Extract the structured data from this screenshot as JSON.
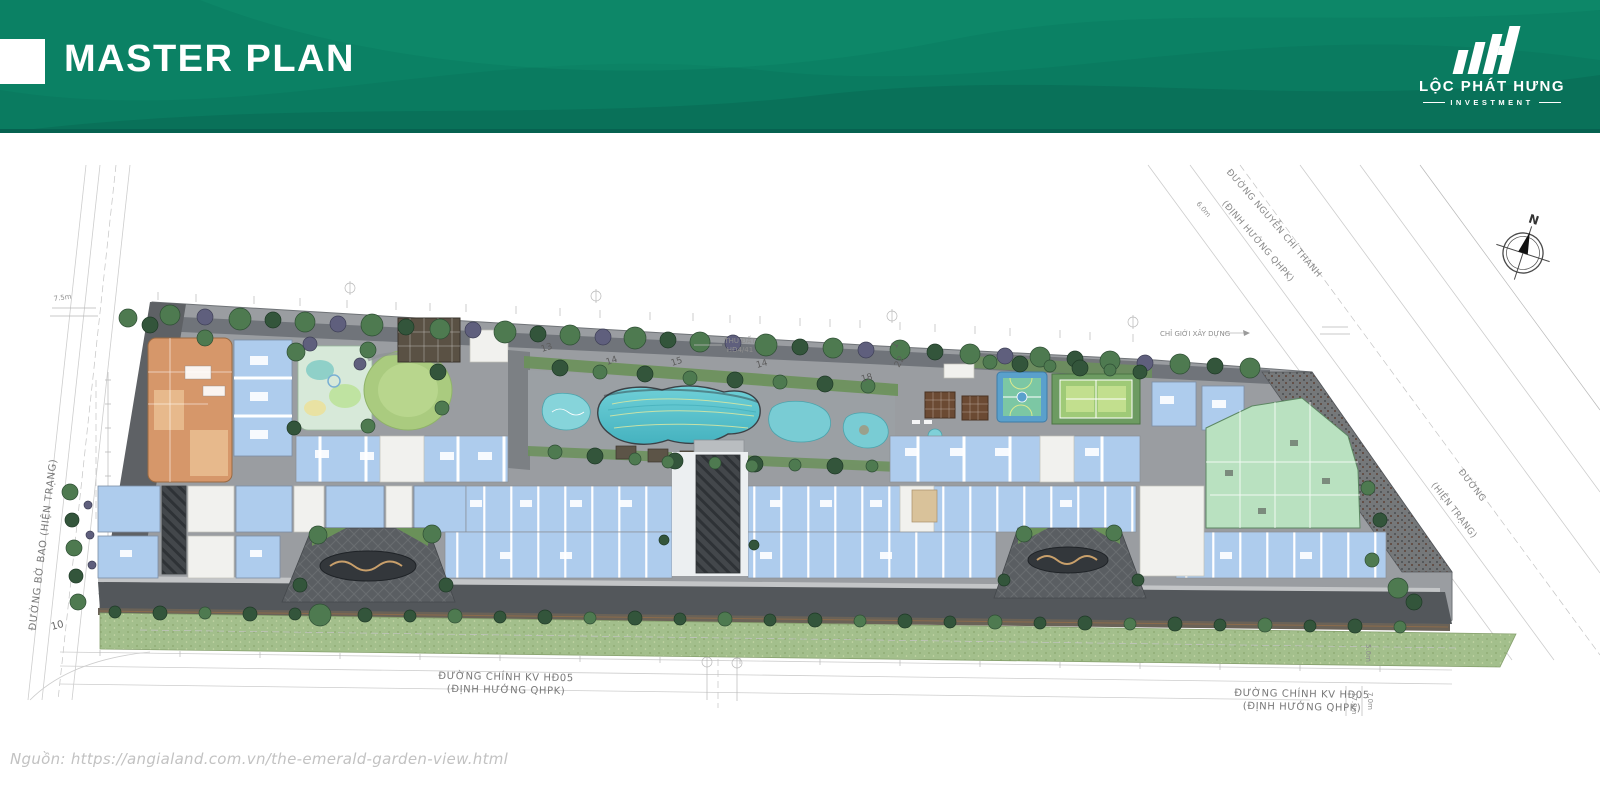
{
  "header": {
    "title": "MASTER PLAN"
  },
  "logo": {
    "name": "LỘC PHÁT HƯNG",
    "tagline": "INVESTMENT"
  },
  "plan": {
    "roads": {
      "left": "ĐƯỜNG BỜ BAO (HIỆN TRẠNG)",
      "top_right_1": "ĐƯỜNG NGUYỄN CHÍ THANH",
      "top_right_2": "(ĐỊNH HƯỚNG QHPK)",
      "right_1": "ĐƯỜNG",
      "right_2": "(HIỆN TRẠNG)",
      "bottom_left_1": "ĐƯỜNG CHÍNH KV HĐ05",
      "bottom_left_2": "(ĐỊNH HƯỚNG QHPK)",
      "bottom_right_1": "ĐƯỜNG CHÍNH KV HĐ05",
      "bottom_right_2": "(ĐỊNH HƯỚNG QHPK)"
    },
    "notes": {
      "setback": "CHỈ GIỚI XÂY DỰNG",
      "land_1": "THU ĐẤT",
      "land_2": "HĐ4/41"
    },
    "dims": {
      "top_left": "7.5m",
      "top_right": "6.0m",
      "right_1": "5.0m",
      "right_2": "17.0m",
      "right_3": "7.0m",
      "corner": "10"
    },
    "compass": {
      "north": "N"
    },
    "markers": [
      "13",
      "14",
      "15",
      "14",
      "18",
      "22",
      "1"
    ]
  },
  "footer": {
    "source": "Nguồn:  https://angialand.com.vn/the-emerald-garden-view.html"
  },
  "colors": {
    "header_green": "#0a7b60",
    "pool_teal": "#5fc6cf",
    "building_blue": "#aecced",
    "building_orange": "#d6976a",
    "building_green": "#b9e1c0",
    "lawn_green": "#aacb7f",
    "road_dark": "#54585c",
    "grass": "#a3bf8c"
  }
}
